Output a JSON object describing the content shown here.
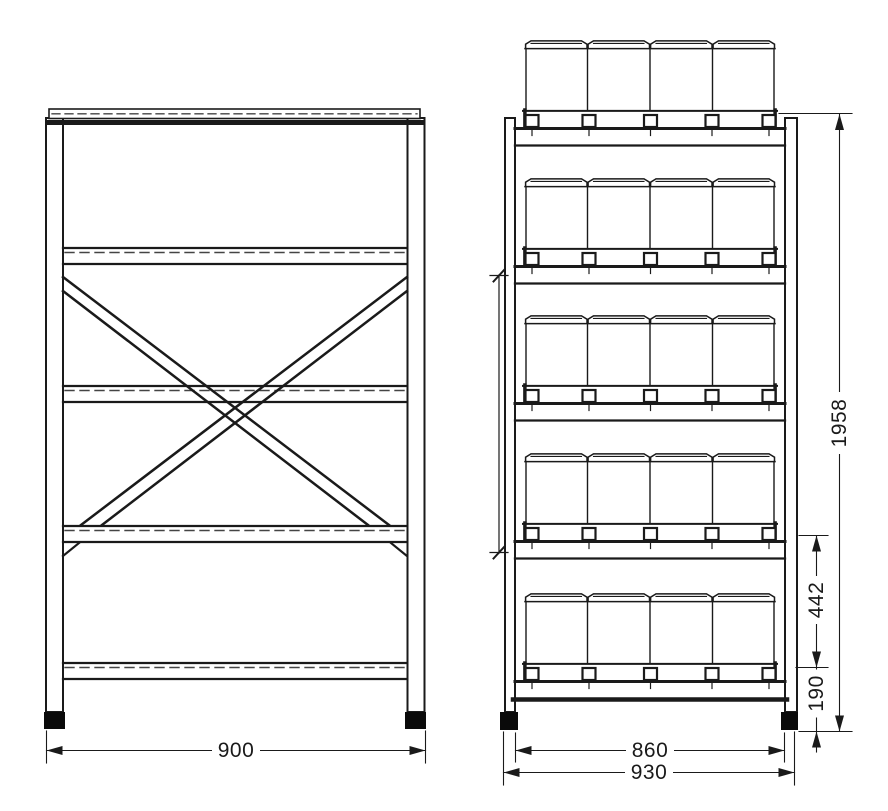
{
  "dimensions": {
    "front_width": "900",
    "side_inner_width": "860",
    "side_outer_width": "930",
    "total_height": "1958",
    "shelf_spacing": "442",
    "base_height": "190"
  }
}
